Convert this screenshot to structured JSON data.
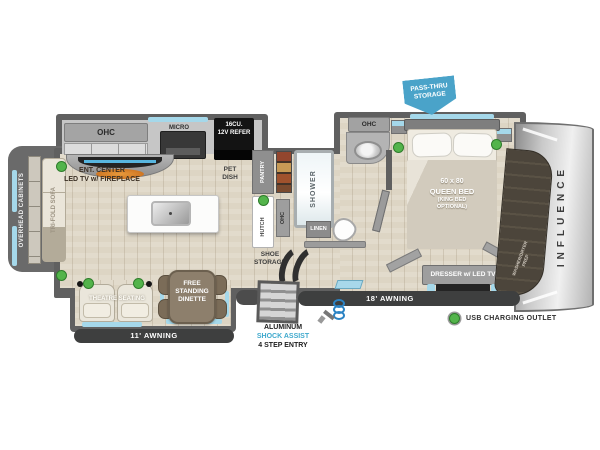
{
  "colors": {
    "wall_gray": "#606060",
    "floor_tan": "#ddd5c4",
    "window_blue": "#a5d8ea",
    "pass_thru_blue": "#4aa3c9",
    "shock_assist_teal": "#3fa9cd",
    "usb_green": "#53b44b",
    "awning_dark": "#3e3f3f"
  },
  "rear": {
    "overhead_cabinets": "OVERHEAD CABINETS",
    "sofa": "TRI-FOLD SOFA"
  },
  "kitchen": {
    "ohc": "OHC",
    "micro": "MICRO",
    "refer1": "16CU.",
    "refer2": "12V REFER",
    "ent1": "ENT. CENTER",
    "ent2": "LED TV w/ FIREPLACE",
    "pet1": "PET",
    "pet2": "DISH",
    "pantry": "PANTRY"
  },
  "bath": {
    "shower": "SHOWER",
    "hutch": "HUTCH",
    "ohc_hutch": "OHC",
    "ohc_sink": "OHC",
    "linen": "LINEN",
    "shoe1": "SHOE",
    "shoe2": "STORAGE"
  },
  "bedroom": {
    "bed1": "60 x 80",
    "bed2": "QUEEN BED",
    "bed3": "(KING BED",
    "bed4": "OPTIONAL)",
    "dresser": "DRESSER w/ LED TV",
    "washer1": "WASHER/DRYER",
    "washer2": "PREP"
  },
  "living": {
    "theatre": "THEATRE SEATING",
    "dinette1": "FREE",
    "dinette2": "STANDING",
    "dinette3": "DINETTE"
  },
  "annotations": {
    "pass1": "PASS-THRU",
    "pass2": "STORAGE",
    "awning18": "18' AWNING",
    "awning11": "11' AWNING",
    "entry1": "ALUMINUM",
    "entry2": "SHOCK ASSIST",
    "entry3": "4 STEP ENTRY",
    "usb": "USB CHARGING OUTLET",
    "brand": "INFLUENCE"
  }
}
